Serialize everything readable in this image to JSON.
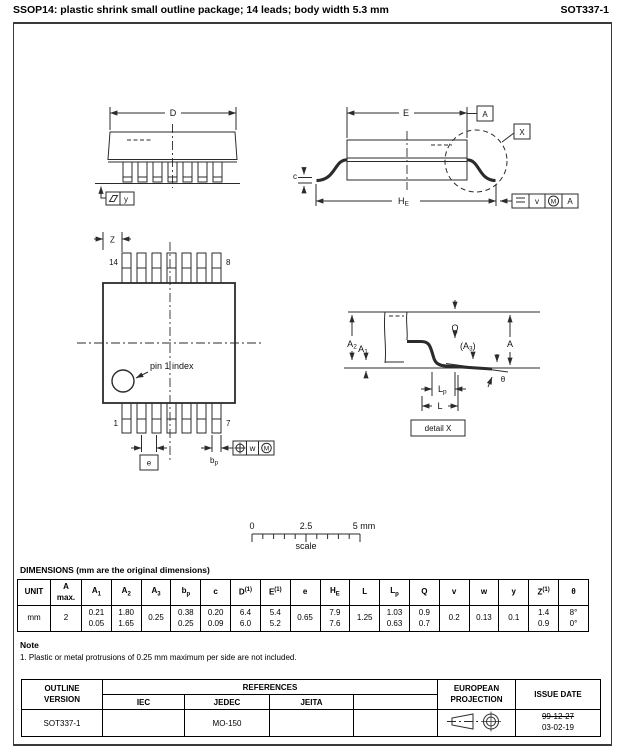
{
  "header": {
    "title": "SSOP14: plastic shrink small outline package; 14 leads; body width 5.3 mm",
    "doc_number": "SOT337-1"
  },
  "front_view": {
    "dim_d": "D",
    "datum_y": "y"
  },
  "side_view": {
    "dim_e": "E",
    "datum_a": "A",
    "detail_ref": "X",
    "dim_c": "c",
    "dim_he_base": "H",
    "dim_he_sub": "E",
    "frame_v": "v",
    "frame_m": "M",
    "frame_a": "A"
  },
  "plan_view": {
    "dim_z": "Z",
    "pin_14": "14",
    "pin_8": "8",
    "pin_1": "1",
    "pin_7": "7",
    "pin1_index": "pin 1 index",
    "dim_e": "e",
    "dim_bp_base": "b",
    "dim_bp_sub": "p",
    "frame_w": "w",
    "frame_m": "M"
  },
  "detail_view": {
    "dim_a2_base": "A",
    "dim_a2_sub": "2",
    "dim_a1_base": "A",
    "dim_a1_sub": "1",
    "dim_q": "Q",
    "dim_a3_pre": "(A",
    "dim_a3_sub": "3",
    "dim_a3_post": ")",
    "dim_a": "A",
    "theta": "θ",
    "dim_lp_base": "L",
    "dim_lp_sub": "p",
    "dim_l": "L",
    "label": "detail X"
  },
  "scale_bar": {
    "tick_0": "0",
    "tick_mid": "2.5",
    "tick_end": "5 mm",
    "label": "scale"
  },
  "dimensions_section": {
    "heading": "DIMENSIONS (mm are the original dimensions)"
  },
  "dims_table": {
    "columns": [
      {
        "base": "UNIT",
        "sub": "",
        "sup": "",
        "line2": ""
      },
      {
        "base": "A",
        "sub": "",
        "sup": "",
        "line2": "max."
      },
      {
        "base": "A",
        "sub": "1",
        "sup": "",
        "line2": ""
      },
      {
        "base": "A",
        "sub": "2",
        "sup": "",
        "line2": ""
      },
      {
        "base": "A",
        "sub": "3",
        "sup": "",
        "line2": ""
      },
      {
        "base": "b",
        "sub": "p",
        "sup": "",
        "line2": ""
      },
      {
        "base": "c",
        "sub": "",
        "sup": "",
        "line2": ""
      },
      {
        "base": "D",
        "sub": "",
        "sup": "(1)",
        "line2": ""
      },
      {
        "base": "E",
        "sub": "",
        "sup": "(1)",
        "line2": ""
      },
      {
        "base": "e",
        "sub": "",
        "sup": "",
        "line2": ""
      },
      {
        "base": "H",
        "sub": "E",
        "sup": "",
        "line2": ""
      },
      {
        "base": "L",
        "sub": "",
        "sup": "",
        "line2": ""
      },
      {
        "base": "L",
        "sub": "p",
        "sup": "",
        "line2": ""
      },
      {
        "base": "Q",
        "sub": "",
        "sup": "",
        "line2": ""
      },
      {
        "base": "v",
        "sub": "",
        "sup": "",
        "line2": ""
      },
      {
        "base": "w",
        "sub": "",
        "sup": "",
        "line2": ""
      },
      {
        "base": "y",
        "sub": "",
        "sup": "",
        "line2": ""
      },
      {
        "base": "Z",
        "sub": "",
        "sup": "(1)",
        "line2": ""
      },
      {
        "base": "θ",
        "sub": "",
        "sup": "",
        "line2": ""
      }
    ],
    "row": [
      {
        "v1": "mm",
        "v2": ""
      },
      {
        "v1": "2",
        "v2": ""
      },
      {
        "v1": "0.21",
        "v2": "0.05"
      },
      {
        "v1": "1.80",
        "v2": "1.65"
      },
      {
        "v1": "0.25",
        "v2": ""
      },
      {
        "v1": "0.38",
        "v2": "0.25"
      },
      {
        "v1": "0.20",
        "v2": "0.09"
      },
      {
        "v1": "6.4",
        "v2": "6.0"
      },
      {
        "v1": "5.4",
        "v2": "5.2"
      },
      {
        "v1": "0.65",
        "v2": ""
      },
      {
        "v1": "7.9",
        "v2": "7.6"
      },
      {
        "v1": "1.25",
        "v2": ""
      },
      {
        "v1": "1.03",
        "v2": "0.63"
      },
      {
        "v1": "0.9",
        "v2": "0.7"
      },
      {
        "v1": "0.2",
        "v2": ""
      },
      {
        "v1": "0.13",
        "v2": ""
      },
      {
        "v1": "0.1",
        "v2": ""
      },
      {
        "v1": "1.4",
        "v2": "0.9"
      },
      {
        "v1": "8°",
        "v2": "0°"
      }
    ]
  },
  "note_section": {
    "heading": "Note",
    "note_1": "1. Plastic or metal protrusions of 0.25 mm maximum per side are not included."
  },
  "references_table": {
    "outline_version_l1": "OUTLINE",
    "outline_version_l2": "VERSION",
    "references_label": "REFERENCES",
    "iec_label": "IEC",
    "jedec_label": "JEDEC",
    "jeita_label": "JEITA",
    "col4_label": "",
    "projection_l1": "EUROPEAN",
    "projection_l2": "PROJECTION",
    "issue_date_label": "ISSUE DATE",
    "row": {
      "outline_version": "SOT337-1",
      "iec": "",
      "jedec": "MO-150",
      "jeita": "",
      "col4": "",
      "issue_date_old": "99-12-27",
      "issue_date_new": "03-02-19"
    }
  }
}
